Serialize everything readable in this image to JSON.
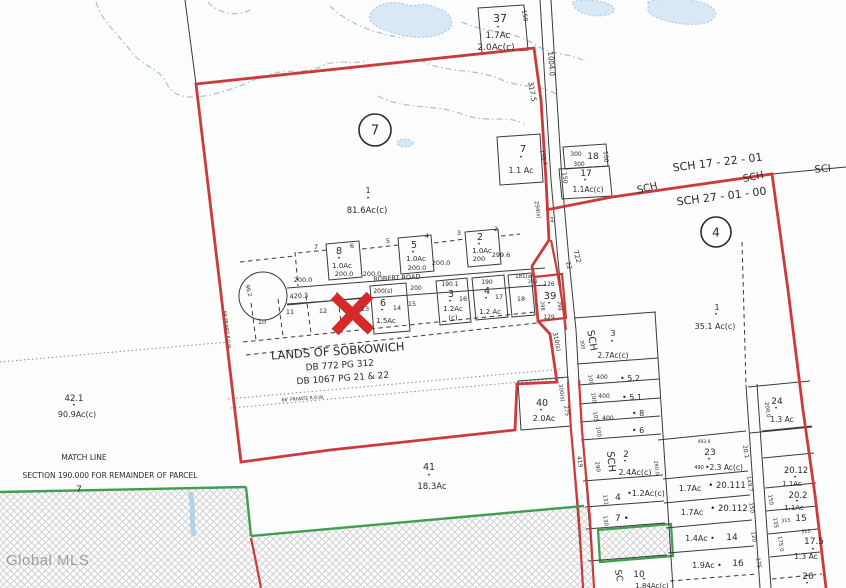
{
  "watermark": "Global MLS",
  "colors": {
    "boundary_red": "#cc3a3a",
    "marker_red": "#d42a2a",
    "map_green": "#3f9e4f",
    "stream_blue": "#a6c6e0",
    "pond_fill": "#d8e8f4",
    "text_color": "#2b2b2b",
    "watermark_gray": "#9a9a9a"
  },
  "labels": [
    {
      "text": "37",
      "x": 500,
      "y": 22,
      "size": 11,
      "name": "lot-37-number"
    },
    {
      "text": "•",
      "x": 498,
      "y": 29,
      "size": 6
    },
    {
      "text": "1.7Ac",
      "x": 498,
      "y": 38,
      "size": 9
    },
    {
      "text": "2.0Ac(c)",
      "x": 496,
      "y": 50,
      "size": 9
    },
    {
      "text": "150",
      "x": 523,
      "y": 16,
      "size": 6,
      "rot": 80
    },
    {
      "text": "1004.0",
      "x": 549,
      "y": 64,
      "size": 7,
      "rot": 85
    },
    {
      "text": "317.5",
      "x": 530,
      "y": 92,
      "size": 7,
      "rot": 80
    },
    {
      "text": "7",
      "x": 523,
      "y": 152,
      "size": 10,
      "name": "lot-7-number"
    },
    {
      "text": "•",
      "x": 521,
      "y": 159,
      "size": 6
    },
    {
      "text": "1.1 Ac",
      "x": 521,
      "y": 173,
      "size": 8
    },
    {
      "text": "159.4",
      "x": 542,
      "y": 158,
      "size": 5.5,
      "rot": 75
    },
    {
      "text": "300",
      "x": 576,
      "y": 156,
      "size": 6
    },
    {
      "text": "18",
      "x": 593,
      "y": 159,
      "size": 9,
      "name": "lot-18-number"
    },
    {
      "text": "100",
      "x": 604,
      "y": 157,
      "size": 6,
      "rot": 85
    },
    {
      "text": "300",
      "x": 579,
      "y": 166,
      "size": 6
    },
    {
      "text": "17",
      "x": 586,
      "y": 176,
      "size": 9,
      "name": "lot-17-number"
    },
    {
      "text": "•",
      "x": 585,
      "y": 182,
      "size": 6
    },
    {
      "text": "1.1Ac(c)",
      "x": 588,
      "y": 192,
      "size": 7.5
    },
    {
      "text": "150",
      "x": 563,
      "y": 178,
      "size": 6,
      "rot": 85
    },
    {
      "text": "SCH 17 - 22 - 01",
      "x": 718,
      "y": 166,
      "size": 11,
      "rot": -7,
      "name": "road-name-sch-17-22-01"
    },
    {
      "text": "SCH",
      "x": 754,
      "y": 180,
      "size": 10,
      "rot": -12
    },
    {
      "text": "SCI",
      "x": 823,
      "y": 172,
      "size": 10,
      "rot": -5
    },
    {
      "text": "SCH",
      "x": 648,
      "y": 191,
      "size": 10,
      "rot": -14
    },
    {
      "text": "SCH 27 - 01 - 00",
      "x": 722,
      "y": 200,
      "size": 11,
      "rot": -7,
      "name": "road-name-sch-27-01-00"
    },
    {
      "text": "4",
      "x": 716,
      "y": 232,
      "size": 12,
      "circled": true,
      "r": 15,
      "name": "section-marker-4"
    },
    {
      "text": "1",
      "x": 717,
      "y": 310,
      "size": 8
    },
    {
      "text": "•",
      "x": 716,
      "y": 316,
      "size": 6
    },
    {
      "text": "35.1 Ac(c)",
      "x": 715,
      "y": 329,
      "size": 8
    },
    {
      "text": "7",
      "x": 375,
      "y": 130,
      "size": 13,
      "circled": true,
      "r": 16,
      "name": "section-marker-7"
    },
    {
      "text": "1",
      "x": 368,
      "y": 193,
      "size": 8,
      "name": "parcel-1-number"
    },
    {
      "text": "•",
      "x": 368,
      "y": 200,
      "size": 6
    },
    {
      "text": "81.6Ac(c)",
      "x": 367,
      "y": 213,
      "size": 8.5,
      "name": "parcel-1-acreage"
    },
    {
      "text": "294(s)",
      "x": 536,
      "y": 210,
      "size": 5.5,
      "rot": 80
    },
    {
      "text": "1",
      "x": 552,
      "y": 222,
      "size": 7
    },
    {
      "text": "722",
      "x": 575,
      "y": 257,
      "size": 7,
      "rot": 75
    },
    {
      "text": "22",
      "x": 567,
      "y": 266,
      "size": 6,
      "rot": 75
    },
    {
      "text": "7",
      "x": 316,
      "y": 249,
      "size": 6.5
    },
    {
      "text": "8",
      "x": 339,
      "y": 254,
      "size": 9.5
    },
    {
      "text": "•",
      "x": 339,
      "y": 260,
      "size": 6
    },
    {
      "text": "6",
      "x": 352,
      "y": 248,
      "size": 6.5
    },
    {
      "text": "1.0Ac",
      "x": 342,
      "y": 268,
      "size": 7
    },
    {
      "text": "200.0",
      "x": 344,
      "y": 276,
      "size": 6.5
    },
    {
      "text": "200.0",
      "x": 303,
      "y": 282,
      "size": 6.5
    },
    {
      "text": "5",
      "x": 388,
      "y": 243,
      "size": 6.5
    },
    {
      "text": "5",
      "x": 414,
      "y": 248,
      "size": 9.5
    },
    {
      "text": "•",
      "x": 413,
      "y": 254,
      "size": 6
    },
    {
      "text": "4",
      "x": 427,
      "y": 238,
      "size": 6.5
    },
    {
      "text": "1.0Ac",
      "x": 416,
      "y": 261,
      "size": 7
    },
    {
      "text": "200.0",
      "x": 417,
      "y": 270,
      "size": 6.5
    },
    {
      "text": "200.0",
      "x": 372,
      "y": 276,
      "size": 6.5
    },
    {
      "text": "3",
      "x": 459,
      "y": 235,
      "size": 6.5
    },
    {
      "text": "2",
      "x": 480,
      "y": 240,
      "size": 9.5
    },
    {
      "text": "•",
      "x": 479,
      "y": 246,
      "size": 6
    },
    {
      "text": "2",
      "x": 496,
      "y": 231,
      "size": 6.5
    },
    {
      "text": "1.0Ac",
      "x": 482,
      "y": 253,
      "size": 7
    },
    {
      "text": "200",
      "x": 479,
      "y": 261,
      "size": 6.5
    },
    {
      "text": "200.0",
      "x": 441,
      "y": 265,
      "size": 6.5
    },
    {
      "text": "299.6",
      "x": 501,
      "y": 257,
      "size": 6.5
    },
    {
      "text": "ROBERT ROAD",
      "x": 397,
      "y": 280,
      "size": 6.5,
      "rot": -3,
      "name": "road-name-robert-road"
    },
    {
      "text": "420.3",
      "x": 299,
      "y": 298,
      "size": 6.5,
      "rot": -4
    },
    {
      "text": "96.2",
      "x": 247,
      "y": 291,
      "size": 5.5,
      "rot": 75
    },
    {
      "text": "200(s)",
      "x": 383,
      "y": 293,
      "size": 6
    },
    {
      "text": "200",
      "x": 416,
      "y": 290,
      "size": 6
    },
    {
      "text": "6",
      "x": 383,
      "y": 306,
      "size": 9.5
    },
    {
      "text": "•",
      "x": 382,
      "y": 312,
      "size": 6
    },
    {
      "text": "14",
      "x": 397,
      "y": 310,
      "size": 6.5
    },
    {
      "text": "1.5Ac",
      "x": 386,
      "y": 323,
      "size": 7
    },
    {
      "text": "15",
      "x": 412,
      "y": 306,
      "size": 6.5
    },
    {
      "text": "190.1",
      "x": 450,
      "y": 286,
      "size": 6
    },
    {
      "text": "3",
      "x": 451,
      "y": 297,
      "size": 9.5
    },
    {
      "text": "•",
      "x": 450,
      "y": 303,
      "size": 6
    },
    {
      "text": "16",
      "x": 463,
      "y": 301,
      "size": 6.5
    },
    {
      "text": "1.2Ac",
      "x": 453,
      "y": 311,
      "size": 7
    },
    {
      "text": "(c)",
      "x": 453,
      "y": 320,
      "size": 7
    },
    {
      "text": "190",
      "x": 487,
      "y": 284,
      "size": 6
    },
    {
      "text": "4",
      "x": 487,
      "y": 294,
      "size": 9.5
    },
    {
      "text": "•",
      "x": 486,
      "y": 300,
      "size": 6
    },
    {
      "text": "17",
      "x": 499,
      "y": 299,
      "size": 6.5
    },
    {
      "text": "1.2 Ac",
      "x": 490,
      "y": 314,
      "size": 7
    },
    {
      "text": "181(s)",
      "x": 524,
      "y": 278,
      "size": 5.5
    },
    {
      "text": "26.1",
      "x": 533,
      "y": 283,
      "size": 4.5
    },
    {
      "text": "18",
      "x": 521,
      "y": 301,
      "size": 6.5
    },
    {
      "text": "10",
      "x": 262,
      "y": 324,
      "size": 6.5
    },
    {
      "text": "11",
      "x": 290,
      "y": 314,
      "size": 6.5
    },
    {
      "text": "12",
      "x": 323,
      "y": 313,
      "size": 6.5
    },
    {
      "text": "13",
      "x": 365,
      "y": 311,
      "size": 6.5
    },
    {
      "text": "126",
      "x": 549,
      "y": 286,
      "size": 6
    },
    {
      "text": "39",
      "x": 550,
      "y": 299,
      "size": 10,
      "name": "lot-39-number"
    },
    {
      "text": "•",
      "x": 549,
      "y": 305,
      "size": 6
    },
    {
      "text": "298",
      "x": 541,
      "y": 306,
      "size": 5,
      "rot": 85
    },
    {
      "text": "299",
      "x": 558,
      "y": 306,
      "size": 5,
      "rot": 85
    },
    {
      "text": "129",
      "x": 549,
      "y": 319,
      "size": 6
    },
    {
      "text": "310(s)",
      "x": 555,
      "y": 342,
      "size": 6,
      "rot": 78
    },
    {
      "text": "LANDS OF SOBKOWICH",
      "x": 338,
      "y": 355,
      "size": 11.5,
      "rot": -4,
      "name": "owner-label"
    },
    {
      "text": "DB 772   PG 312",
      "x": 340,
      "y": 368,
      "size": 9,
      "rot": -4,
      "name": "deed-book-1"
    },
    {
      "text": "DB 1067   PG 21 & 22",
      "x": 343,
      "y": 381,
      "size": 9,
      "rot": -4,
      "name": "deed-book-2"
    },
    {
      "text": "66' PRIVATE  R.O.W.",
      "x": 303,
      "y": 400,
      "size": 4.5,
      "rot": -4
    },
    {
      "text": "66' PRIVATE  R.O.W.",
      "x": 226,
      "y": 330,
      "size": 4,
      "rot": 83
    },
    {
      "text": "42.1",
      "x": 74,
      "y": 401,
      "size": 8.5,
      "name": "parcel-42-1-number"
    },
    {
      "text": "•",
      "x": 74,
      "y": 407,
      "size": 6
    },
    {
      "text": "90.9Ac(c)",
      "x": 77,
      "y": 417,
      "size": 8
    },
    {
      "text": "MATCH LINE",
      "x": 84,
      "y": 460,
      "size": 7.5,
      "name": "match-line-label"
    },
    {
      "text": "SECTION 190.000 FOR REMAINDER OF PARCEL",
      "x": 110,
      "y": 478,
      "size": 7.5,
      "name": "section-note"
    },
    {
      "text": "7",
      "x": 79,
      "y": 492,
      "size": 9
    },
    {
      "text": "40",
      "x": 542,
      "y": 406,
      "size": 9.5,
      "name": "lot-40-number"
    },
    {
      "text": "•",
      "x": 541,
      "y": 412,
      "size": 6
    },
    {
      "text": "2.0Ac",
      "x": 544,
      "y": 421,
      "size": 8
    },
    {
      "text": "300(s)",
      "x": 560,
      "y": 393,
      "size": 5.5,
      "rot": 82
    },
    {
      "text": "275",
      "x": 565,
      "y": 411,
      "size": 5.5,
      "rot": 82
    },
    {
      "text": "41",
      "x": 429,
      "y": 470,
      "size": 9.5,
      "name": "lot-41-number"
    },
    {
      "text": "•",
      "x": 429,
      "y": 477,
      "size": 6
    },
    {
      "text": "18.3Ac",
      "x": 432,
      "y": 489,
      "size": 8.5
    },
    {
      "text": "419",
      "x": 578,
      "y": 462,
      "size": 6,
      "rot": 80
    },
    {
      "text": "SCH",
      "x": 589,
      "y": 341,
      "size": 10,
      "rot": 80
    },
    {
      "text": "300",
      "x": 581,
      "y": 345,
      "size": 5,
      "rot": 80
    },
    {
      "text": "3",
      "x": 613,
      "y": 336,
      "size": 8
    },
    {
      "text": "•",
      "x": 612,
      "y": 343,
      "size": 6
    },
    {
      "text": "2.7Ac(c)",
      "x": 613,
      "y": 358,
      "size": 7.5
    },
    {
      "text": "400",
      "x": 602,
      "y": 379,
      "size": 6
    },
    {
      "text": "• 5.2",
      "x": 630,
      "y": 381,
      "size": 8
    },
    {
      "text": "100",
      "x": 589,
      "y": 380,
      "size": 5.5,
      "rot": 82
    },
    {
      "text": "400",
      "x": 604,
      "y": 398,
      "size": 6
    },
    {
      "text": "• 5.1",
      "x": 632,
      "y": 400,
      "size": 8
    },
    {
      "text": "100",
      "x": 592,
      "y": 398,
      "size": 5.5,
      "rot": 82
    },
    {
      "text": "400",
      "x": 608,
      "y": 420,
      "size": 6
    },
    {
      "text": "• 8",
      "x": 638,
      "y": 416,
      "size": 8
    },
    {
      "text": "105",
      "x": 594,
      "y": 417,
      "size": 5.5,
      "rot": 82
    },
    {
      "text": "• 6",
      "x": 638,
      "y": 433,
      "size": 8
    },
    {
      "text": "100",
      "x": 597,
      "y": 432,
      "size": 5.5,
      "rot": 82
    },
    {
      "text": "SCH",
      "x": 608,
      "y": 462,
      "size": 10,
      "rot": 85
    },
    {
      "text": "2",
      "x": 626,
      "y": 457,
      "size": 9
    },
    {
      "text": "•",
      "x": 625,
      "y": 463,
      "size": 6
    },
    {
      "text": "2.4Ac(c)",
      "x": 635,
      "y": 475,
      "size": 8
    },
    {
      "text": "290",
      "x": 596,
      "y": 467,
      "size": 5.5,
      "rot": 82
    },
    {
      "text": "260.0",
      "x": 655,
      "y": 468,
      "size": 5,
      "rot": 82
    },
    {
      "text": "4",
      "x": 618,
      "y": 500,
      "size": 9
    },
    {
      "text": "•1.2Ac(c)",
      "x": 646,
      "y": 496,
      "size": 8
    },
    {
      "text": "131",
      "x": 604,
      "y": 500,
      "size": 5.5,
      "rot": 82
    },
    {
      "text": "7  •",
      "x": 622,
      "y": 521,
      "size": 9
    },
    {
      "text": "130",
      "x": 604,
      "y": 521,
      "size": 5.5,
      "rot": 82
    },
    {
      "text": "SC",
      "x": 616,
      "y": 576,
      "size": 9,
      "rot": 80
    },
    {
      "text": "10",
      "x": 639,
      "y": 577,
      "size": 9
    },
    {
      "text": "•",
      "x": 644,
      "y": 581,
      "size": 6
    },
    {
      "text": "1.84Ac(c)",
      "x": 652,
      "y": 588,
      "size": 7
    },
    {
      "text": "24",
      "x": 777,
      "y": 404,
      "size": 9,
      "name": "lot-24-number"
    },
    {
      "text": "•",
      "x": 776,
      "y": 410,
      "size": 6
    },
    {
      "text": "200.0",
      "x": 766,
      "y": 410,
      "size": 5.5,
      "rot": 82
    },
    {
      "text": "1.3 Ac",
      "x": 782,
      "y": 422,
      "size": 7.5
    },
    {
      "text": "493.9",
      "x": 704,
      "y": 443,
      "size": 4.5
    },
    {
      "text": "23",
      "x": 710,
      "y": 455,
      "size": 9,
      "name": "lot-23-number"
    },
    {
      "text": "•",
      "x": 709,
      "y": 461,
      "size": 6
    },
    {
      "text": "490",
      "x": 699,
      "y": 469,
      "size": 5
    },
    {
      "text": "•2.3 Ac(c)",
      "x": 724,
      "y": 470,
      "size": 7.5
    },
    {
      "text": "20.1",
      "x": 744,
      "y": 452,
      "size": 6,
      "rot": 80
    },
    {
      "text": "1.7Ac",
      "x": 690,
      "y": 491,
      "size": 8
    },
    {
      "text": "• 20.111",
      "x": 727,
      "y": 488,
      "size": 8.5
    },
    {
      "text": "149.7",
      "x": 748,
      "y": 484,
      "size": 5.5,
      "rot": 82
    },
    {
      "text": "1.7Ac",
      "x": 692,
      "y": 515,
      "size": 8
    },
    {
      "text": "• 20.112",
      "x": 729,
      "y": 511,
      "size": 8.5
    },
    {
      "text": "150",
      "x": 750,
      "y": 508,
      "size": 5.5,
      "rot": 82
    },
    {
      "text": "1.4Ac •",
      "x": 700,
      "y": 541,
      "size": 8
    },
    {
      "text": "14",
      "x": 732,
      "y": 540,
      "size": 9
    },
    {
      "text": "120",
      "x": 752,
      "y": 537,
      "size": 5.5,
      "rot": 82
    },
    {
      "text": "1.9Ac •",
      "x": 707,
      "y": 568,
      "size": 8
    },
    {
      "text": "16",
      "x": 738,
      "y": 566,
      "size": 9
    },
    {
      "text": "175",
      "x": 757,
      "y": 563,
      "size": 5.5,
      "rot": 82
    },
    {
      "text": "150",
      "x": 769,
      "y": 500,
      "size": 5.5,
      "rot": 82
    },
    {
      "text": "135",
      "x": 774,
      "y": 523,
      "size": 5.5,
      "rot": 82
    },
    {
      "text": "175.0",
      "x": 779,
      "y": 544,
      "size": 5.5,
      "rot": 82
    },
    {
      "text": "20.12",
      "x": 796,
      "y": 473,
      "size": 8.5
    },
    {
      "text": "•",
      "x": 795,
      "y": 479,
      "size": 6
    },
    {
      "text": "1.1Ac",
      "x": 792,
      "y": 486,
      "size": 7
    },
    {
      "text": "20.2",
      "x": 798,
      "y": 498,
      "size": 8.5
    },
    {
      "text": "•",
      "x": 797,
      "y": 503,
      "size": 6
    },
    {
      "text": "1.1Ac",
      "x": 794,
      "y": 510,
      "size": 7
    },
    {
      "text": "315",
      "x": 786,
      "y": 522,
      "size": 5,
      "rot": -6
    },
    {
      "text": "15",
      "x": 801,
      "y": 521,
      "size": 9
    },
    {
      "text": "315",
      "x": 806,
      "y": 533,
      "size": 5,
      "rot": -6
    },
    {
      "text": "17.5",
      "x": 814,
      "y": 544,
      "size": 9
    },
    {
      "text": "•",
      "x": 813,
      "y": 551,
      "size": 6
    },
    {
      "text": "1.3 Ac",
      "x": 806,
      "y": 559,
      "size": 7.5
    },
    {
      "text": "26",
      "x": 808,
      "y": 579,
      "size": 9
    },
    {
      "text": "•",
      "x": 807,
      "y": 585,
      "size": 6
    }
  ]
}
